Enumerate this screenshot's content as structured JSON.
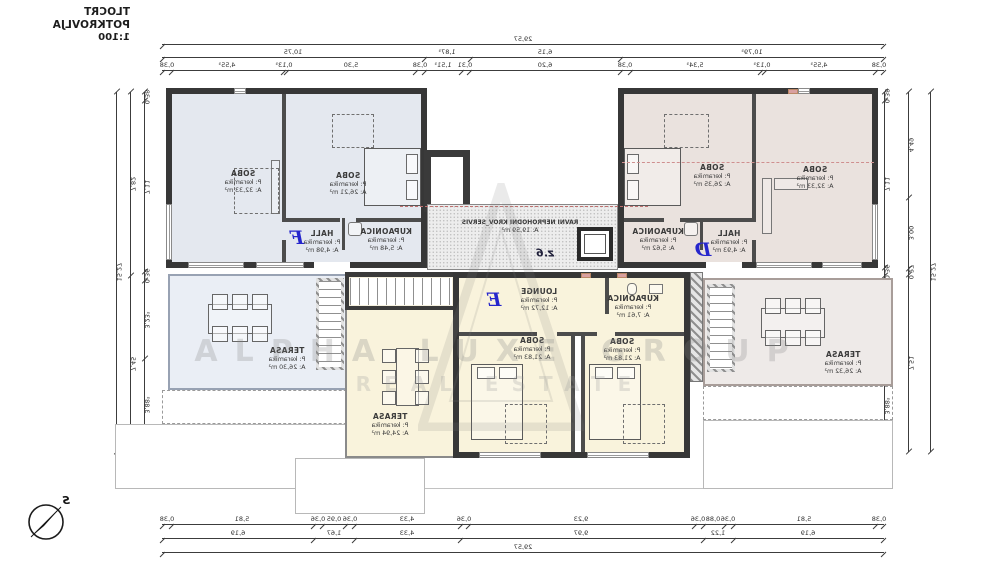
{
  "title": {
    "line1": "TLOCRT POTKROVLJA",
    "line2": "1:100"
  },
  "compass": {
    "letter": "S"
  },
  "watermark": {
    "line1": "ALPHA LUXE GROUP",
    "line2": "REAL ESTATE"
  },
  "apartments": {
    "f": "F",
    "d": "D",
    "e": "E"
  },
  "rooms": {
    "f_soba_left": {
      "name": "SOBA",
      "floor": "P: keramika",
      "area": "A: 32,33 m²"
    },
    "f_soba_right": {
      "name": "SOBA",
      "floor": "P: keramika",
      "area": "A: 26,21 m²"
    },
    "f_hall": {
      "name": "HALL",
      "floor": "P: keramika",
      "area": "A: 4,98 m²"
    },
    "f_kupaonica": {
      "name": "KUPAONICA",
      "floor": "P: keramika",
      "area": "A: 5,48 m²"
    },
    "f_terasa": {
      "name": "TERASA",
      "floor": "P: keramika",
      "area": "A: 26,30 m²"
    },
    "d_soba_left": {
      "name": "SOBA",
      "floor": "P: keramika",
      "area": "A: 26,35 m²"
    },
    "d_soba_right": {
      "name": "SOBA",
      "floor": "P: keramika",
      "area": "A: 32,33 m²"
    },
    "d_hall": {
      "name": "HALL",
      "floor": "P: keramika",
      "area": "A: 4,93 m²"
    },
    "d_kupaonica": {
      "name": "KUPAONICA",
      "floor": "P: keramika",
      "area": "A: 5,62 m²"
    },
    "d_terasa": {
      "name": "TERASA",
      "floor": "P: keramika",
      "area": "A: 26,32 m²"
    },
    "e_lounge": {
      "name": "LOUNGE",
      "floor": "P: keramika",
      "area": "A: 12,72 m²"
    },
    "e_kupaonica": {
      "name": "KUPAONICA",
      "floor": "P: keramika",
      "area": "A: 7,61 m²"
    },
    "e_soba_left": {
      "name": "SOBA",
      "floor": "P: keramika",
      "area": "A: 21,83 m²"
    },
    "e_soba_right": {
      "name": "SOBA",
      "floor": "P: keramika",
      "area": "A: 21,83 m²"
    },
    "e_terasa": {
      "name": "TERASA",
      "floor": "P: keramika",
      "area": "A: 24,94 m²"
    },
    "roof": {
      "name": "RAVNI NEPROHODNI KROV_SERVIS",
      "area": "A: 19,59 m²",
      "mark": "z.6"
    }
  },
  "dims": {
    "top_row1": [
      {
        "t": "29,57",
        "v": 29.57
      }
    ],
    "top_row2": [
      {
        "t": "10,75",
        "v": 10.75
      },
      {
        "t": "1,87⁵",
        "v": 1.875
      },
      {
        "t": "6,15",
        "v": 6.15
      },
      {
        "t": "10,79⁵",
        "v": 10.795
      }
    ],
    "top_row3": [
      {
        "t": "0,38",
        "v": 0.38
      },
      {
        "t": "4,55⁵",
        "v": 4.555
      },
      {
        "t": "0,13⁵",
        "v": 0.135
      },
      {
        "t": "5,30",
        "v": 5.3
      },
      {
        "t": "0,38",
        "v": 0.38
      },
      {
        "t": "1,51⁵",
        "v": 1.515
      },
      {
        "t": "0,31",
        "v": 0.31
      },
      {
        "t": "6,20",
        "v": 6.2
      },
      {
        "t": "0,38",
        "v": 0.38
      },
      {
        "t": "5,34⁵",
        "v": 5.345
      },
      {
        "t": "0,13⁵",
        "v": 0.135
      },
      {
        "t": "4,55⁵",
        "v": 4.555
      },
      {
        "t": "0,38",
        "v": 0.38
      }
    ],
    "bottom_row1": [
      {
        "t": "0,38",
        "v": 0.38
      },
      {
        "t": "5,81",
        "v": 5.81
      },
      {
        "t": "0,36",
        "v": 0.36
      },
      {
        "t": "0,95",
        "v": 0.95
      },
      {
        "t": "0,36",
        "v": 0.36
      },
      {
        "t": "4,33",
        "v": 4.33
      },
      {
        "t": "0,36",
        "v": 0.36
      },
      {
        "t": "9,23",
        "v": 9.23
      },
      {
        "t": "0,36",
        "v": 0.36
      },
      {
        "t": "0,88",
        "v": 0.88
      },
      {
        "t": "0,36",
        "v": 0.36
      },
      {
        "t": "5,81",
        "v": 5.81
      },
      {
        "t": "0,38",
        "v": 0.38
      }
    ],
    "bottom_row2": [
      {
        "t": "6,19",
        "v": 6.19
      },
      {
        "t": "1,67",
        "v": 1.67
      },
      {
        "t": "4,33",
        "v": 4.33
      },
      {
        "t": "9,97",
        "v": 9.97
      },
      {
        "t": "1,22",
        "v": 1.22
      },
      {
        "t": "6,19",
        "v": 6.19
      }
    ],
    "bottom_row3": [
      {
        "t": "29,57",
        "v": 29.57
      }
    ],
    "left_col1": [
      {
        "t": "15,27",
        "v": 15.27
      }
    ],
    "left_col2": [
      {
        "t": "7,82",
        "v": 7.82
      },
      {
        "t": "7,45",
        "v": 7.45
      }
    ],
    "left_col3": [
      {
        "t": "0,38",
        "v": 0.38
      },
      {
        "t": "7,11",
        "v": 7.11
      },
      {
        "t": "0,36",
        "v": 0.36
      },
      {
        "t": "3,23⁵",
        "v": 3.235
      },
      {
        "t": "3,88⁵",
        "v": 3.885
      }
    ],
    "right_col1": [
      {
        "t": "0,38",
        "v": 0.38
      },
      {
        "t": "7,11",
        "v": 7.11
      },
      {
        "t": "0,36",
        "v": 0.36
      },
      {
        "t": "3,62⁵",
        "v": 3.625
      },
      {
        "t": "3,88⁵",
        "v": 3.885
      }
    ],
    "right_col2": [
      {
        "t": "4,49",
        "v": 4.49
      },
      {
        "t": "3,00",
        "v": 3.0
      },
      {
        "t": "0,27",
        "v": 0.27
      },
      {
        "t": "7,51",
        "v": 7.51
      }
    ],
    "right_col3": [
      {
        "t": "15,27",
        "v": 15.27
      }
    ]
  },
  "colors": {
    "apt_f": "#e4e8ef",
    "apt_d": "#eae2de",
    "apt_e": "#f9f3dc",
    "ter_f": "#eaeef5",
    "ter_d": "#eeeae8",
    "wall": "#373737",
    "letter": "#2626cc",
    "section": "#c07070"
  }
}
